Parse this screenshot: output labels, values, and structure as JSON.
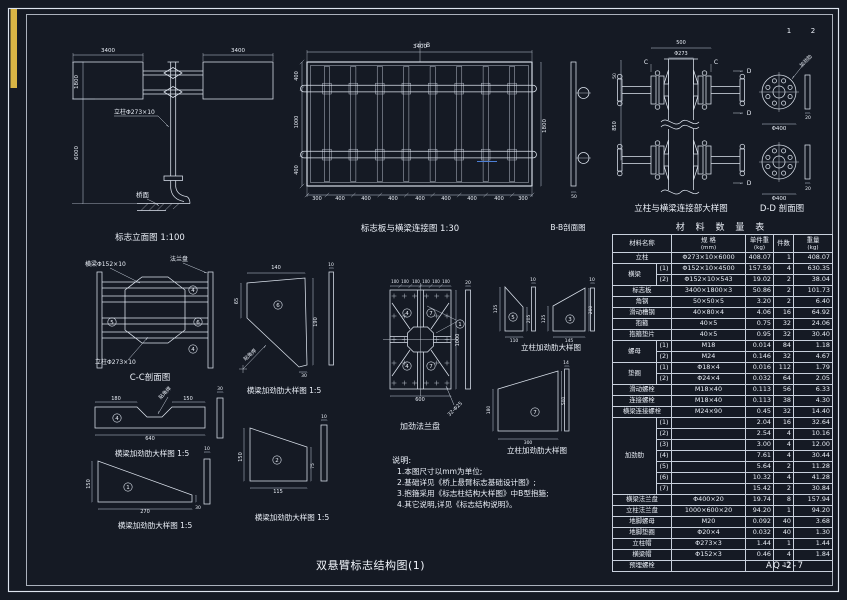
{
  "page": {
    "title": "双悬臂标志结构图(1)",
    "drawing_no": "AQ-2-7",
    "sheet_no_1": "1",
    "sheet_no_2": "2",
    "accent_yellow": "#d9b545",
    "accent_blue": "#4d7fd6",
    "line_color": "#dde4ee",
    "background": "#151a24"
  },
  "notes": {
    "heading": "说明:",
    "items": [
      "1.本图尺寸以mm为单位;",
      "2.基础详见《桥上悬臂标志基础设计图》;",
      "3.抱箍采用《标志柱结构大样图》中B型抱箍;",
      "4.其它说明,详见《标志结构说明》。"
    ]
  },
  "table": {
    "title": "材 料 数 量 表",
    "headers": [
      {
        "label": "材料名称",
        "unit": ""
      },
      {
        "label": "规 格",
        "unit": "(mm)"
      },
      {
        "label": "单件重",
        "unit": "(kg)"
      },
      {
        "label": "件数",
        "unit": ""
      },
      {
        "label": "重量",
        "unit": "(kg)"
      }
    ],
    "rows": [
      {
        "name": "立柱",
        "spec": "Φ273×10×6000",
        "unit": "408.07",
        "count": "1",
        "total": "408.07"
      },
      {
        "name": "横梁",
        "span": 2,
        "sub": "(1)",
        "spec": "Φ152×10×4500",
        "unit": "157.59",
        "count": "4",
        "total": "630.35"
      },
      {
        "sub": "(2)",
        "spec": "Φ152×10×543",
        "unit": "19.02",
        "count": "2",
        "total": "38.04"
      },
      {
        "name": "标志板",
        "spec": "3400×1800×3",
        "unit": "50.86",
        "count": "2",
        "total": "101.73"
      },
      {
        "name": "角钢",
        "spec": "50×50×5",
        "unit": "3.20",
        "count": "2",
        "total": "6.40"
      },
      {
        "name": "滑动槽钢",
        "spec": "40×80×4",
        "unit": "4.06",
        "count": "16",
        "total": "64.92"
      },
      {
        "name": "抱箍",
        "spec": "40×5",
        "unit": "0.75",
        "count": "32",
        "total": "24.06"
      },
      {
        "name": "抱箍垫片",
        "spec": "40×5",
        "unit": "0.95",
        "count": "32",
        "total": "30.40"
      },
      {
        "name": "螺母",
        "span": 2,
        "sub": "(1)",
        "spec": "M18",
        "unit": "0.014",
        "count": "84",
        "total": "1.18"
      },
      {
        "sub": "(2)",
        "spec": "M24",
        "unit": "0.146",
        "count": "32",
        "total": "4.67"
      },
      {
        "name": "垫圈",
        "span": 2,
        "sub": "(1)",
        "spec": "Φ18×4",
        "unit": "0.016",
        "count": "112",
        "total": "1.79"
      },
      {
        "sub": "(2)",
        "spec": "Φ24×4",
        "unit": "0.032",
        "count": "64",
        "total": "2.05"
      },
      {
        "name": "滑动螺栓",
        "spec": "M18×40",
        "unit": "0.113",
        "count": "56",
        "total": "6.33"
      },
      {
        "name": "连接螺栓",
        "spec": "M18×40",
        "unit": "0.113",
        "count": "38",
        "total": "4.30"
      },
      {
        "name": "横梁连接螺栓",
        "spec": "M24×90",
        "unit": "0.45",
        "count": "32",
        "total": "14.40"
      },
      {
        "name": "加劲肋",
        "span": 7,
        "sub": "(1)",
        "spec": "",
        "unit": "2.04",
        "count": "16",
        "total": "32.64"
      },
      {
        "sub": "(2)",
        "spec": "",
        "unit": "2.54",
        "count": "4",
        "total": "10.16"
      },
      {
        "sub": "(3)",
        "spec": "",
        "unit": "3.00",
        "count": "4",
        "total": "12.00"
      },
      {
        "sub": "(4)",
        "spec": "",
        "unit": "7.61",
        "count": "4",
        "total": "30.44"
      },
      {
        "sub": "(5)",
        "spec": "",
        "unit": "5.64",
        "count": "2",
        "total": "11.28"
      },
      {
        "sub": "(6)",
        "spec": "",
        "unit": "10.32",
        "count": "4",
        "total": "41.28"
      },
      {
        "sub": "(7)",
        "spec": "",
        "unit": "15.42",
        "count": "2",
        "total": "30.84"
      },
      {
        "name": "横梁法兰盘",
        "spec": "Φ400×20",
        "unit": "19.74",
        "count": "8",
        "total": "157.94"
      },
      {
        "name": "立柱法兰盘",
        "spec": "1000×600×20",
        "unit": "94.20",
        "count": "1",
        "total": "94.20"
      },
      {
        "name": "地脚螺母",
        "spec": "M20",
        "unit": "0.092",
        "count": "40",
        "total": "3.68"
      },
      {
        "name": "地脚垫圈",
        "spec": "Φ20×4",
        "unit": "0.032",
        "count": "40",
        "total": "1.30"
      },
      {
        "name": "立柱帽",
        "spec": "Φ273×3",
        "unit": "1.44",
        "count": "1",
        "total": "1.44"
      },
      {
        "name": "横梁帽",
        "spec": "Φ152×3",
        "unit": "0.46",
        "count": "4",
        "total": "1.84"
      },
      {
        "name": "预埋螺栓",
        "spec": "",
        "unit": "",
        "count": "12",
        "total": ""
      }
    ]
  },
  "labels": [
    {
      "name": "sheet-number-1",
      "t": "1",
      "x": 789,
      "y": 33,
      "s": 7
    },
    {
      "name": "sheet-number-2",
      "t": "2",
      "x": 813,
      "y": 33,
      "s": 7
    },
    {
      "name": "dim",
      "t": "3400",
      "x": 108,
      "y": 52
    },
    {
      "name": "dim",
      "t": "3400",
      "x": 238,
      "y": 52
    },
    {
      "name": "dim",
      "t": "1800",
      "x": 78,
      "y": 82,
      "r": -90
    },
    {
      "name": "dim",
      "t": "6000",
      "x": 78,
      "y": 153,
      "r": -90
    },
    {
      "name": "column-callout",
      "t": "立柱Φ273×10",
      "x": 114,
      "y": 114,
      "s": 6,
      "a": "start"
    },
    {
      "name": "deck-label",
      "t": "桥面",
      "x": 136,
      "y": 197,
      "s": 6.5,
      "a": "start"
    },
    {
      "name": "caption-elevation",
      "t": "标志立面图 1:100",
      "x": 150,
      "y": 240,
      "s": 8.5
    },
    {
      "name": "dim",
      "t": "3400",
      "x": 420,
      "y": 48
    },
    {
      "name": "section-mark",
      "t": "B",
      "x": 428,
      "y": 47,
      "s": 6
    },
    {
      "name": "dim",
      "t": "300",
      "x": 317,
      "y": 200,
      "s": 5
    },
    {
      "name": "dim",
      "t": "400",
      "x": 340,
      "y": 200,
      "s": 5
    },
    {
      "name": "dim",
      "t": "400",
      "x": 366,
      "y": 200,
      "s": 5
    },
    {
      "name": "dim",
      "t": "400",
      "x": 393,
      "y": 200,
      "s": 5
    },
    {
      "name": "dim",
      "t": "400",
      "x": 420,
      "y": 200,
      "s": 5
    },
    {
      "name": "dim",
      "t": "400",
      "x": 446,
      "y": 200,
      "s": 5
    },
    {
      "name": "dim",
      "t": "400",
      "x": 472,
      "y": 200,
      "s": 5
    },
    {
      "name": "dim",
      "t": "400",
      "x": 499,
      "y": 200,
      "s": 5
    },
    {
      "name": "dim",
      "t": "300",
      "x": 523,
      "y": 200,
      "s": 5
    },
    {
      "name": "dim",
      "t": "1800",
      "x": 546,
      "y": 126,
      "r": -90
    },
    {
      "name": "dim",
      "t": "400",
      "x": 298,
      "y": 76,
      "s": 5,
      "r": -90
    },
    {
      "name": "dim",
      "t": "1000",
      "x": 298,
      "y": 122,
      "s": 5,
      "r": -90
    },
    {
      "name": "dim",
      "t": "400",
      "x": 298,
      "y": 170,
      "s": 5,
      "r": -90
    },
    {
      "name": "caption-board-connection",
      "t": "标志板与横梁连接图  1:30",
      "x": 410,
      "y": 231,
      "s": 8.5
    },
    {
      "name": "caption-bb-section",
      "t": "B-B剖面图",
      "x": 568,
      "y": 230,
      "s": 7.5
    },
    {
      "name": "dim",
      "t": "50",
      "x": 574,
      "y": 198,
      "s": 4.5
    },
    {
      "name": "dim",
      "t": "500",
      "x": 681,
      "y": 44,
      "s": 5
    },
    {
      "name": "dim",
      "t": "Φ273",
      "x": 681,
      "y": 55,
      "s": 5
    },
    {
      "name": "section-mark",
      "t": "C",
      "x": 646,
      "y": 64,
      "s": 6
    },
    {
      "name": "section-mark",
      "t": "C",
      "x": 716,
      "y": 64,
      "s": 6
    },
    {
      "name": "section-mark",
      "t": "D",
      "x": 749,
      "y": 73,
      "s": 6
    },
    {
      "name": "section-mark",
      "t": "D",
      "x": 749,
      "y": 115,
      "s": 6
    },
    {
      "name": "section-mark",
      "t": "D",
      "x": 749,
      "y": 185,
      "s": 6
    },
    {
      "name": "dim",
      "t": "50",
      "x": 616,
      "y": 76,
      "s": 4.5,
      "r": -90
    },
    {
      "name": "dim",
      "t": "850",
      "x": 616,
      "y": 126,
      "s": 5,
      "r": -90
    },
    {
      "name": "caption-joint-detail",
      "t": "立柱与横梁连接部大样图",
      "x": 681,
      "y": 211,
      "s": 8.5
    },
    {
      "name": "caption-dd-section",
      "t": "D-D 剖面图",
      "x": 782,
      "y": 211,
      "s": 8.5
    },
    {
      "name": "dim",
      "t": "Φ400",
      "x": 779,
      "y": 130,
      "s": 5.5
    },
    {
      "name": "dim",
      "t": "Φ400",
      "x": 779,
      "y": 200,
      "s": 5.5
    },
    {
      "name": "stiffener-callout",
      "t": "加劲肋",
      "x": 807,
      "y": 62,
      "s": 5,
      "r": -45
    },
    {
      "name": "dim",
      "t": "20",
      "x": 808,
      "y": 119,
      "s": 4.5
    },
    {
      "name": "dim",
      "t": "20",
      "x": 808,
      "y": 190,
      "s": 4.5
    },
    {
      "name": "beam-callout",
      "t": "横梁Φ152×10",
      "x": 85,
      "y": 266,
      "s": 6,
      "a": "start"
    },
    {
      "name": "flange-callout",
      "t": "法兰盘",
      "x": 170,
      "y": 261,
      "s": 6,
      "a": "start"
    },
    {
      "name": "column-callout",
      "t": "立柱Φ273×10",
      "x": 95,
      "y": 364,
      "s": 6,
      "a": "start"
    },
    {
      "name": "caption-cc-section",
      "t": "C-C剖面图",
      "x": 150,
      "y": 380,
      "s": 8.5
    },
    {
      "name": "dim",
      "t": "140",
      "x": 276,
      "y": 269,
      "s": 5
    },
    {
      "name": "dim",
      "t": "65",
      "x": 238,
      "y": 301,
      "s": 5,
      "r": -90
    },
    {
      "name": "dim",
      "t": "190",
      "x": 317,
      "y": 322,
      "s": 5,
      "r": -90
    },
    {
      "name": "dim",
      "t": "30",
      "x": 304,
      "y": 377,
      "s": 4.5
    },
    {
      "name": "weld-callout",
      "t": "贴角焊",
      "x": 251,
      "y": 356,
      "s": 5,
      "r": -42
    },
    {
      "name": "dim",
      "t": "10",
      "x": 331,
      "y": 266,
      "s": 4.5
    },
    {
      "name": "caption-beam-stiffener",
      "t": "横梁加劲肋大样图 1:5",
      "x": 284,
      "y": 393,
      "s": 7.5
    },
    {
      "name": "dim",
      "t": "100",
      "x": 395,
      "y": 283,
      "s": 4
    },
    {
      "name": "dim",
      "t": "100",
      "x": 405,
      "y": 283,
      "s": 4
    },
    {
      "name": "dim",
      "t": "100",
      "x": 416,
      "y": 283,
      "s": 4
    },
    {
      "name": "dim",
      "t": "100",
      "x": 426,
      "y": 283,
      "s": 4
    },
    {
      "name": "dim",
      "t": "100",
      "x": 436,
      "y": 283,
      "s": 4
    },
    {
      "name": "dim",
      "t": "100",
      "x": 446,
      "y": 283,
      "s": 4
    },
    {
      "name": "dim",
      "t": "1000",
      "x": 459,
      "y": 340,
      "s": 5,
      "r": -90
    },
    {
      "name": "dim",
      "t": "600",
      "x": 420,
      "y": 401,
      "s": 5
    },
    {
      "name": "bolt-callout",
      "t": "32-Φ25",
      "x": 456,
      "y": 410,
      "s": 5,
      "r": -45
    },
    {
      "name": "dim",
      "t": "20",
      "x": 468,
      "y": 284,
      "s": 4.5
    },
    {
      "name": "caption-stiffened-flange",
      "t": "加劲法兰盘",
      "x": 420,
      "y": 429,
      "s": 8
    },
    {
      "name": "dim",
      "t": "125",
      "x": 497,
      "y": 309,
      "s": 4.5,
      "r": -90
    },
    {
      "name": "dim",
      "t": "110",
      "x": 514,
      "y": 342,
      "s": 4.5
    },
    {
      "name": "dim",
      "t": "205",
      "x": 530,
      "y": 319,
      "s": 4.5,
      "r": -90
    },
    {
      "name": "dim",
      "t": "10",
      "x": 533,
      "y": 281,
      "s": 4.5
    },
    {
      "name": "dim",
      "t": "125",
      "x": 545,
      "y": 319,
      "s": 4.5,
      "r": -90
    },
    {
      "name": "dim",
      "t": "145",
      "x": 569,
      "y": 342,
      "s": 4.5
    },
    {
      "name": "dim",
      "t": "200",
      "x": 592,
      "y": 310,
      "s": 4.5,
      "r": -90
    },
    {
      "name": "dim",
      "t": "10",
      "x": 592,
      "y": 281,
      "s": 4.5
    },
    {
      "name": "caption-column-stiffener",
      "t": "立柱加劲肋大样图",
      "x": 551,
      "y": 350,
      "s": 7.5
    },
    {
      "name": "dim",
      "t": "180",
      "x": 490,
      "y": 410,
      "s": 4.5,
      "r": -90
    },
    {
      "name": "dim",
      "t": "300",
      "x": 528,
      "y": 444,
      "s": 4.5
    },
    {
      "name": "dim",
      "t": "500",
      "x": 565,
      "y": 401,
      "s": 4.5,
      "r": -90
    },
    {
      "name": "dim",
      "t": "14",
      "x": 566,
      "y": 364,
      "s": 4.5
    },
    {
      "name": "caption-column-stiffener",
      "t": "立柱加劲肋大样图",
      "x": 537,
      "y": 453,
      "s": 7.5
    },
    {
      "name": "dim",
      "t": "180",
      "x": 116,
      "y": 400,
      "s": 5
    },
    {
      "name": "dim",
      "t": "150",
      "x": 188,
      "y": 400,
      "s": 5
    },
    {
      "name": "dim",
      "t": "640",
      "x": 150,
      "y": 440,
      "s": 5
    },
    {
      "name": "weld-callout",
      "t": "贴角焊",
      "x": 166,
      "y": 394,
      "s": 5,
      "r": -45
    },
    {
      "name": "dim",
      "t": "30",
      "x": 220,
      "y": 390,
      "s": 4.5
    },
    {
      "name": "caption-beam-stiffener",
      "t": "横梁加劲肋大样图 1:5",
      "x": 152,
      "y": 456,
      "s": 7.5
    },
    {
      "name": "dim",
      "t": "150",
      "x": 90,
      "y": 484,
      "s": 5,
      "r": -90
    },
    {
      "name": "dim",
      "t": "270",
      "x": 145,
      "y": 513,
      "s": 5
    },
    {
      "name": "dim",
      "t": "30",
      "x": 198,
      "y": 509,
      "s": 4.5
    },
    {
      "name": "dim",
      "t": "10",
      "x": 207,
      "y": 450,
      "s": 4.5
    },
    {
      "name": "caption-beam-stiffener",
      "t": "横梁加劲肋大样图 1:5",
      "x": 155,
      "y": 528,
      "s": 7.5
    },
    {
      "name": "dim",
      "t": "150",
      "x": 242,
      "y": 457,
      "s": 5,
      "r": -90
    },
    {
      "name": "dim",
      "t": "115",
      "x": 278,
      "y": 493,
      "s": 5
    },
    {
      "name": "dim",
      "t": "75",
      "x": 314,
      "y": 466,
      "s": 4.5,
      "r": -90
    },
    {
      "name": "dim",
      "t": "10",
      "x": 324,
      "y": 418,
      "s": 4.5
    },
    {
      "name": "caption-beam-stiffener",
      "t": "横梁加劲肋大样图 1:5",
      "x": 292,
      "y": 520,
      "s": 7.5
    }
  ],
  "circled_numbers": [
    {
      "n": "4",
      "x": 193,
      "y": 290
    },
    {
      "n": "5",
      "x": 112,
      "y": 322
    },
    {
      "n": "6",
      "x": 198,
      "y": 322
    },
    {
      "n": "4",
      "x": 193,
      "y": 349
    },
    {
      "n": "6",
      "x": 278,
      "y": 305
    },
    {
      "n": "4",
      "x": 407,
      "y": 313
    },
    {
      "n": "7",
      "x": 431,
      "y": 313
    },
    {
      "n": "4",
      "x": 407,
      "y": 366
    },
    {
      "n": "7",
      "x": 431,
      "y": 366
    },
    {
      "n": "1",
      "x": 460,
      "y": 324
    },
    {
      "n": "5",
      "x": 513,
      "y": 317
    },
    {
      "n": "3",
      "x": 570,
      "y": 319
    },
    {
      "n": "7",
      "x": 535,
      "y": 412
    },
    {
      "n": "4",
      "x": 117,
      "y": 418
    },
    {
      "n": "1",
      "x": 128,
      "y": 487
    },
    {
      "n": "2",
      "x": 277,
      "y": 460
    }
  ]
}
